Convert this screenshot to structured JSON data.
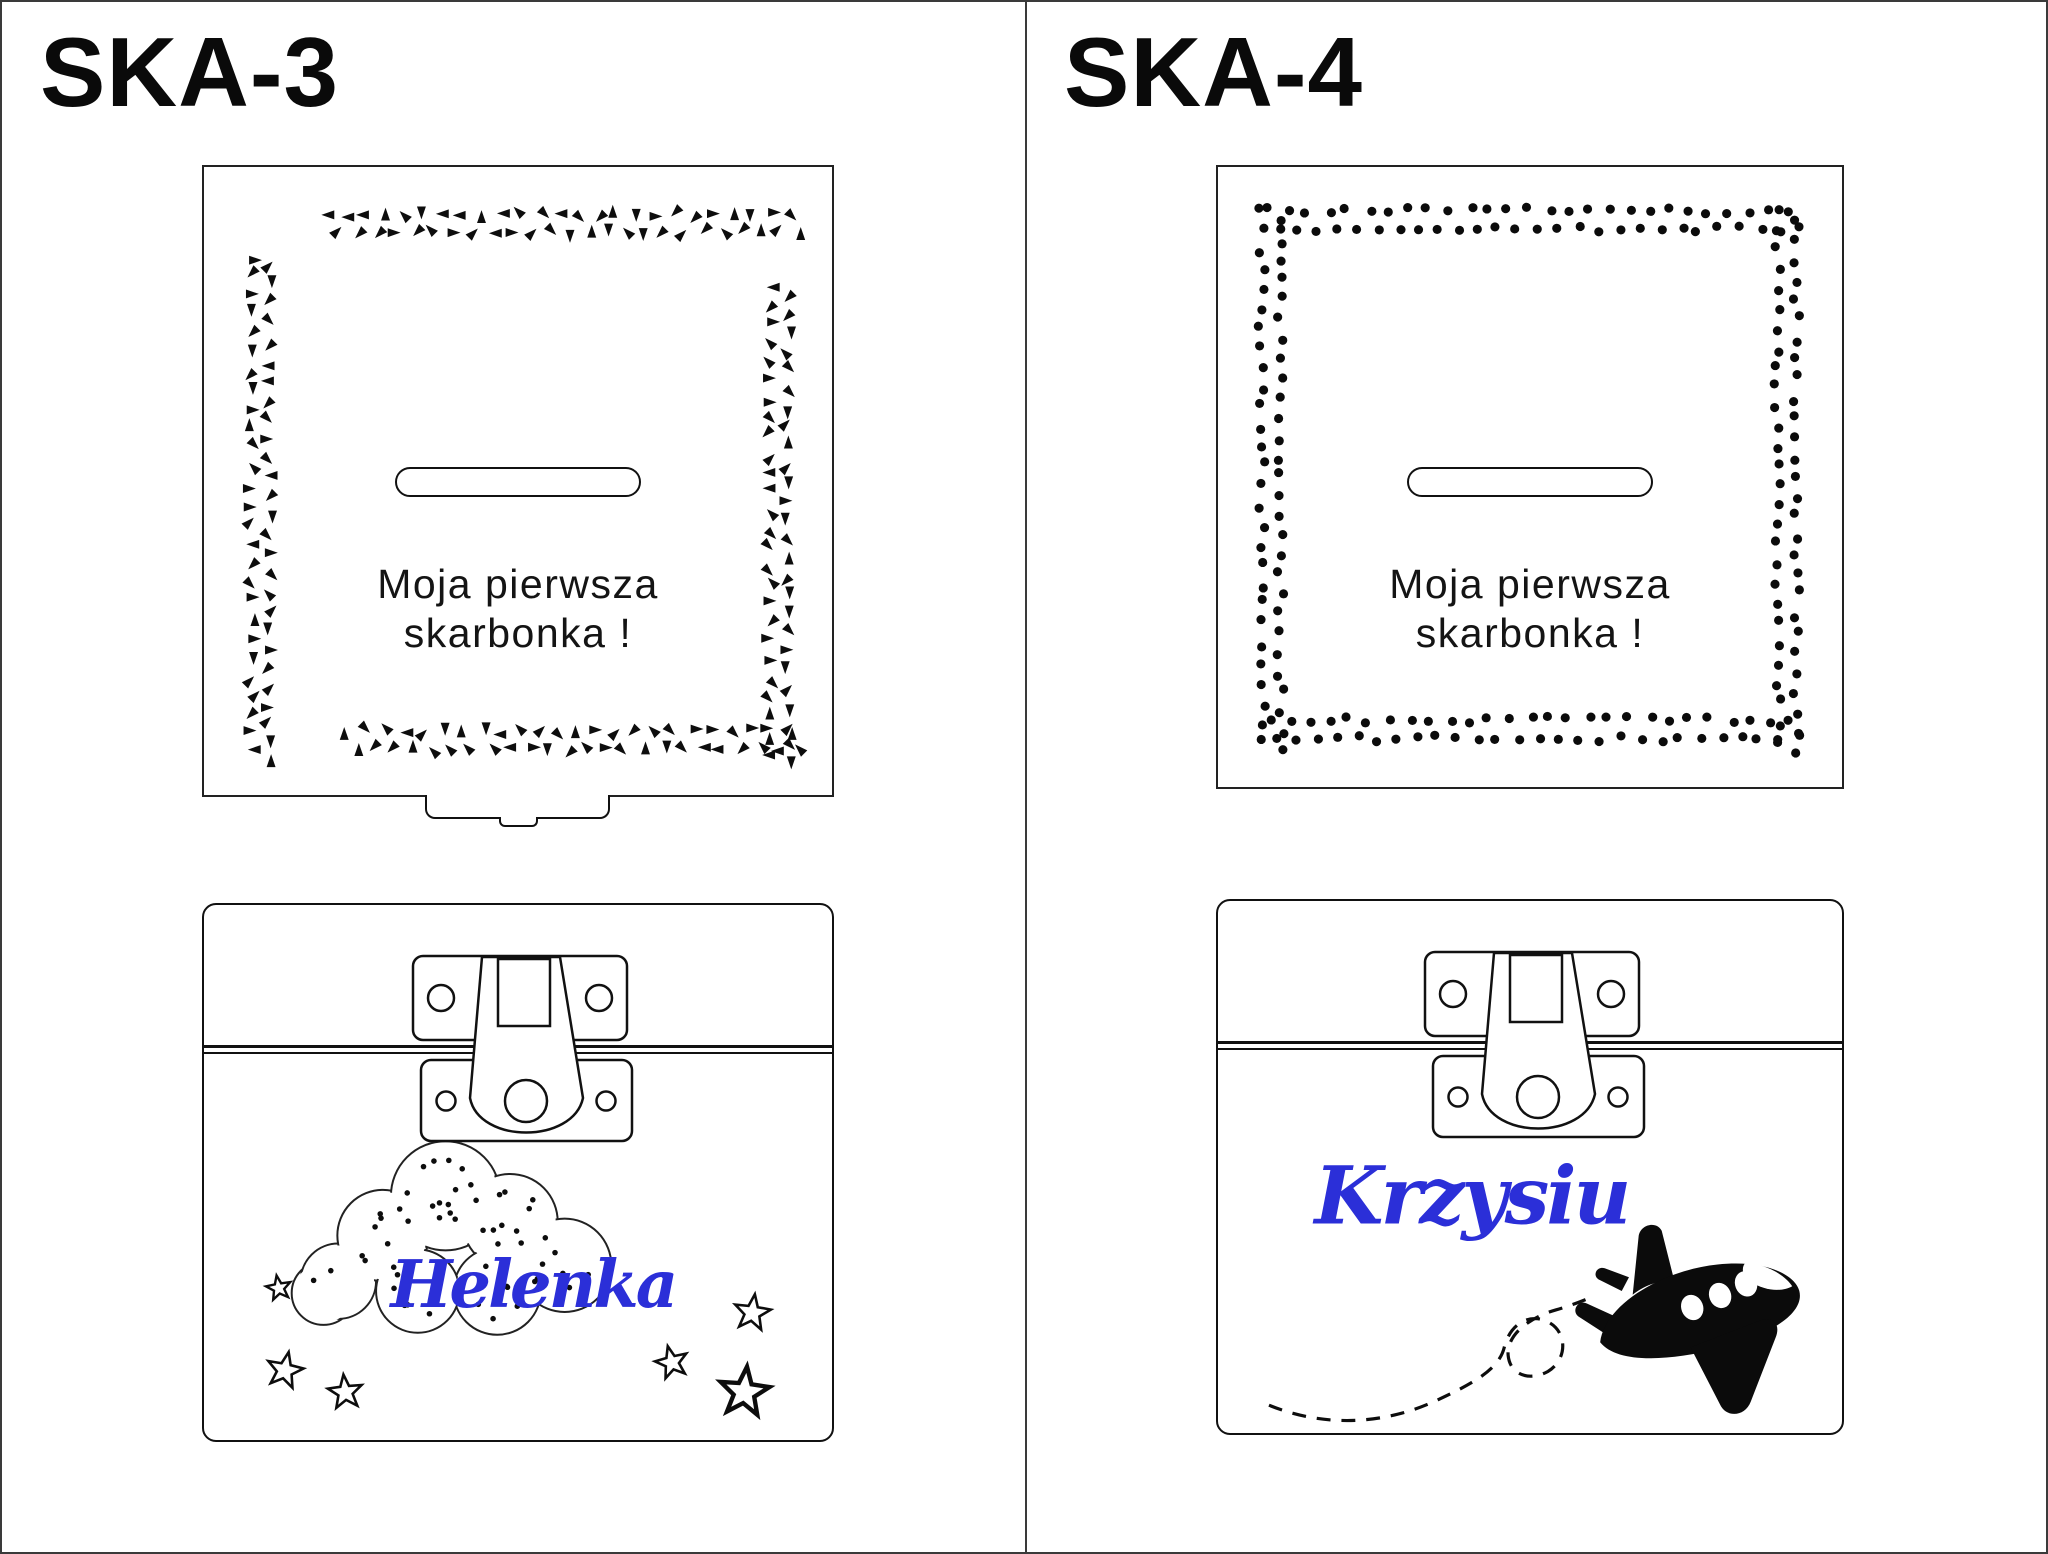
{
  "sheet": {
    "divider_color": "#3a3a3a",
    "ink_color": "#0d0d0d",
    "accent_blue": "#2b2fd8"
  },
  "panels": [
    {
      "title": "SKA-3",
      "lid": {
        "caption_line1": "Moja pierwsza",
        "caption_line2": "skarbonka !",
        "border_decor": "triangle-scatter",
        "has_hinge_tab": true,
        "slot": "coin-slot"
      },
      "front": {
        "name": "Helenka",
        "motif": "cloud-with-stars",
        "hardware": "latch-clasp"
      }
    },
    {
      "title": "SKA-4",
      "lid": {
        "caption_line1": "Moja pierwsza",
        "caption_line2": "skarbonka !",
        "border_decor": "dot-scatter",
        "has_hinge_tab": false,
        "slot": "coin-slot"
      },
      "front": {
        "name": "Krzysiu",
        "motif": "airplane-with-trail",
        "hardware": "latch-clasp"
      }
    }
  ]
}
